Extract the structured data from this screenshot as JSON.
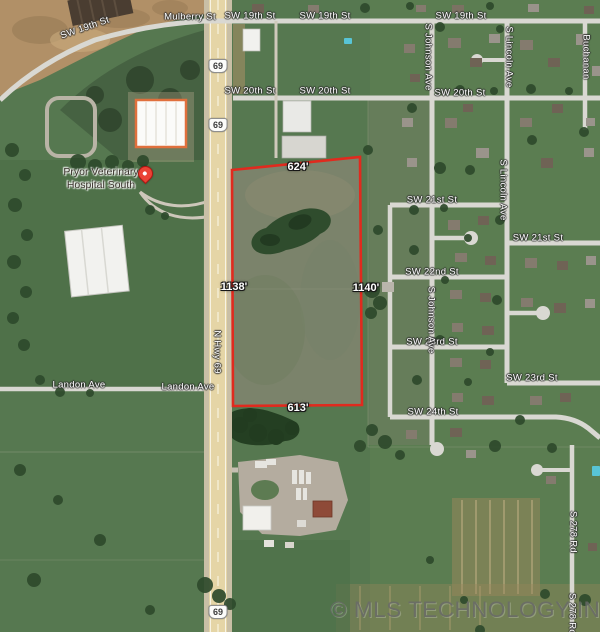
{
  "map": {
    "watermark": "© MLS TECHNOLOGY INC 2025",
    "poi": {
      "line1": "Pryor Veterinary",
      "line2": "Hospital South"
    },
    "parcel": {
      "top_ft": "624'",
      "west_ft": "1138'",
      "east_ft": "1140'",
      "bottom_ft": "613'",
      "outline_color": "#e02a1e"
    },
    "highway": {
      "shield": "69",
      "name": "N Hwy 69"
    },
    "streets": {
      "mulberry": "Mulberry St",
      "sw19": "SW 19th St",
      "sw20": "SW 20th St",
      "sw21": "SW 21st St",
      "sw22": "SW 22nd St",
      "sw23": "SW 23rd St",
      "sw24": "SW 24th St",
      "landon": "Landon Ave",
      "s_johnson": "S Johnson Ave",
      "s_lincoln": "S Lincoln Ave",
      "buchanan": "Buchanan",
      "s_278_rd": "S 278 Rd"
    }
  }
}
